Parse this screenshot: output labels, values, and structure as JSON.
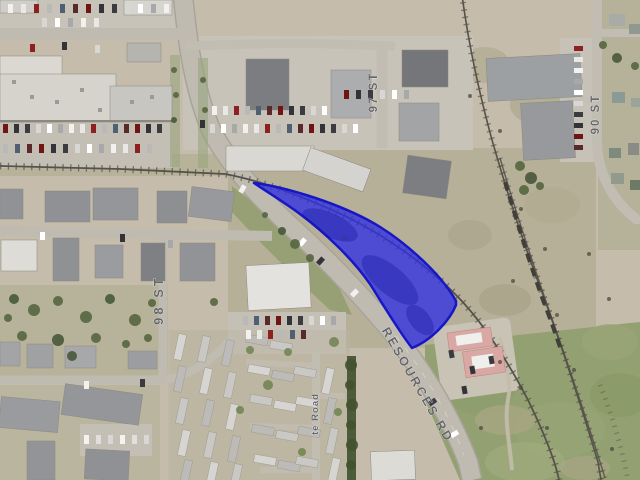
{
  "map": {
    "street_labels": [
      {
        "id": "st_98",
        "text": "98 ST"
      },
      {
        "id": "st_97",
        "text": "97 ST"
      },
      {
        "id": "st_90",
        "text": "90 ST"
      },
      {
        "id": "resources_rd",
        "text": "RESOURCES RD"
      },
      {
        "id": "park_road",
        "text": "te Road"
      }
    ],
    "label_color": "#5a5a61",
    "highlight": {
      "path": "M254,183 C280,186 330,200 368,220 C400,237 440,272 456,301 L456,305 C450,320 432,340 412,348 C398,330 384,306 370,284 C352,258 324,232 300,214 C284,202 264,190 254,183 Z",
      "fill": "#2f2fe2",
      "fill_opacity": "0.78",
      "stroke": "#1717c6",
      "stroke_width": "2.5"
    }
  }
}
